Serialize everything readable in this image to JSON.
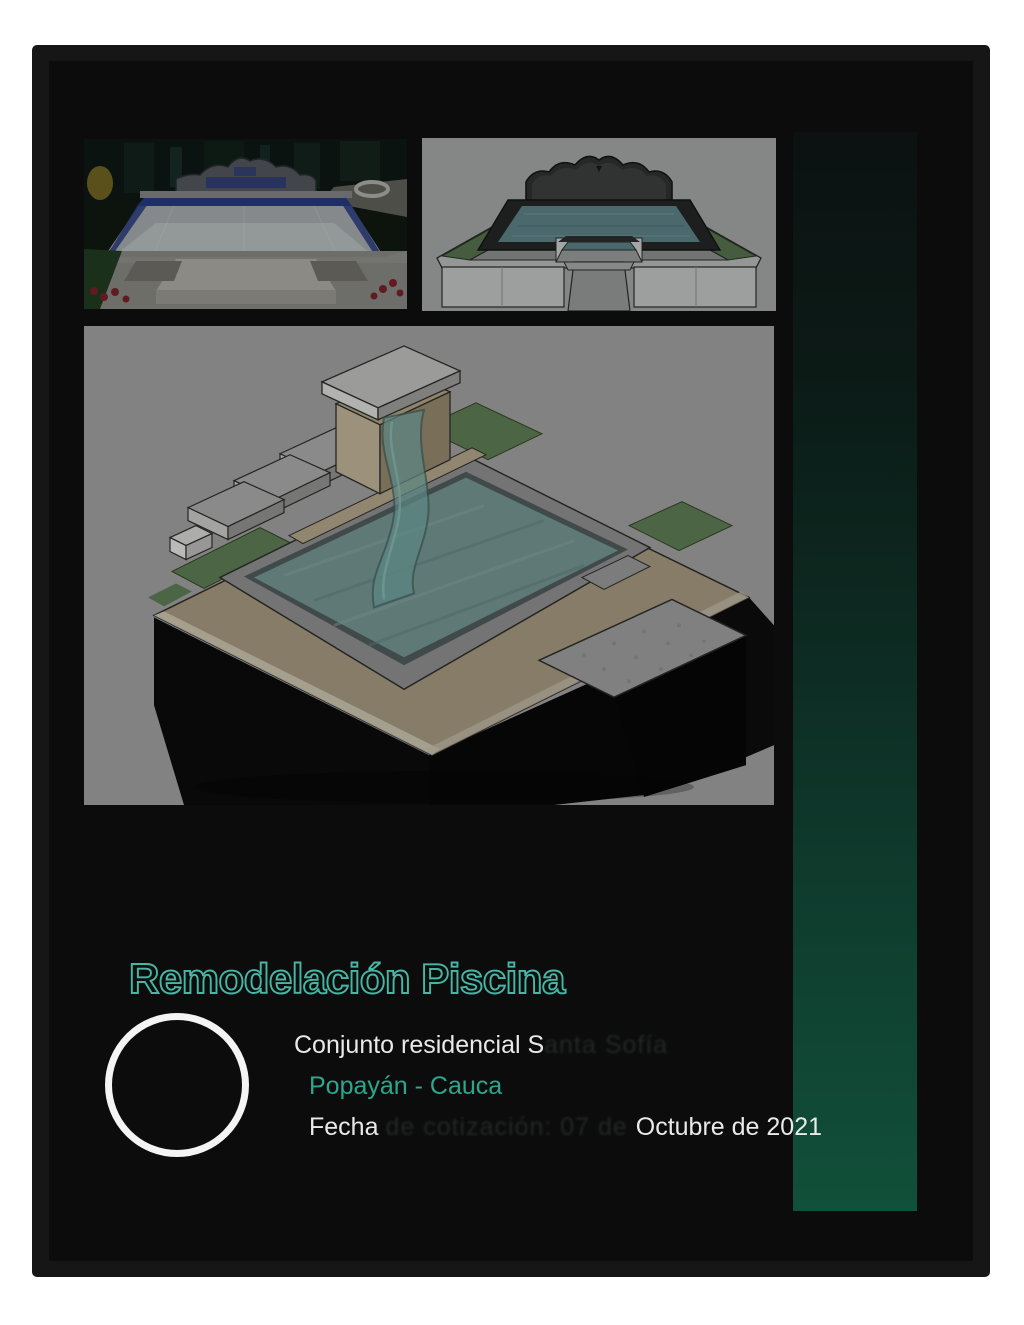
{
  "page": {
    "title": "Remodelación Piscina"
  },
  "info": {
    "residence_visible": "Conjunto residencial S",
    "residence_ghost": "anta Sofía",
    "location": "Popayán - Cauca",
    "date_prefix": "Fecha ",
    "date_ghost": "de cotización: 07 de ",
    "date_visible": "Octubre de 2021"
  },
  "images": {
    "photo_before": "pool-before-renovation-photo",
    "render_front": "pool-3d-render-front-view",
    "render_iso": "pool-3d-render-isometric-waterfall"
  },
  "colors": {
    "accent_teal": "#48b6a5",
    "location_teal": "#2ba78f",
    "accent_bar_top": "#0b1211",
    "accent_bar_bottom": "#11503a",
    "panel_background": "#0c0c0d",
    "page_background": "#ffffff",
    "circle_stroke": "#f4f4f4"
  }
}
